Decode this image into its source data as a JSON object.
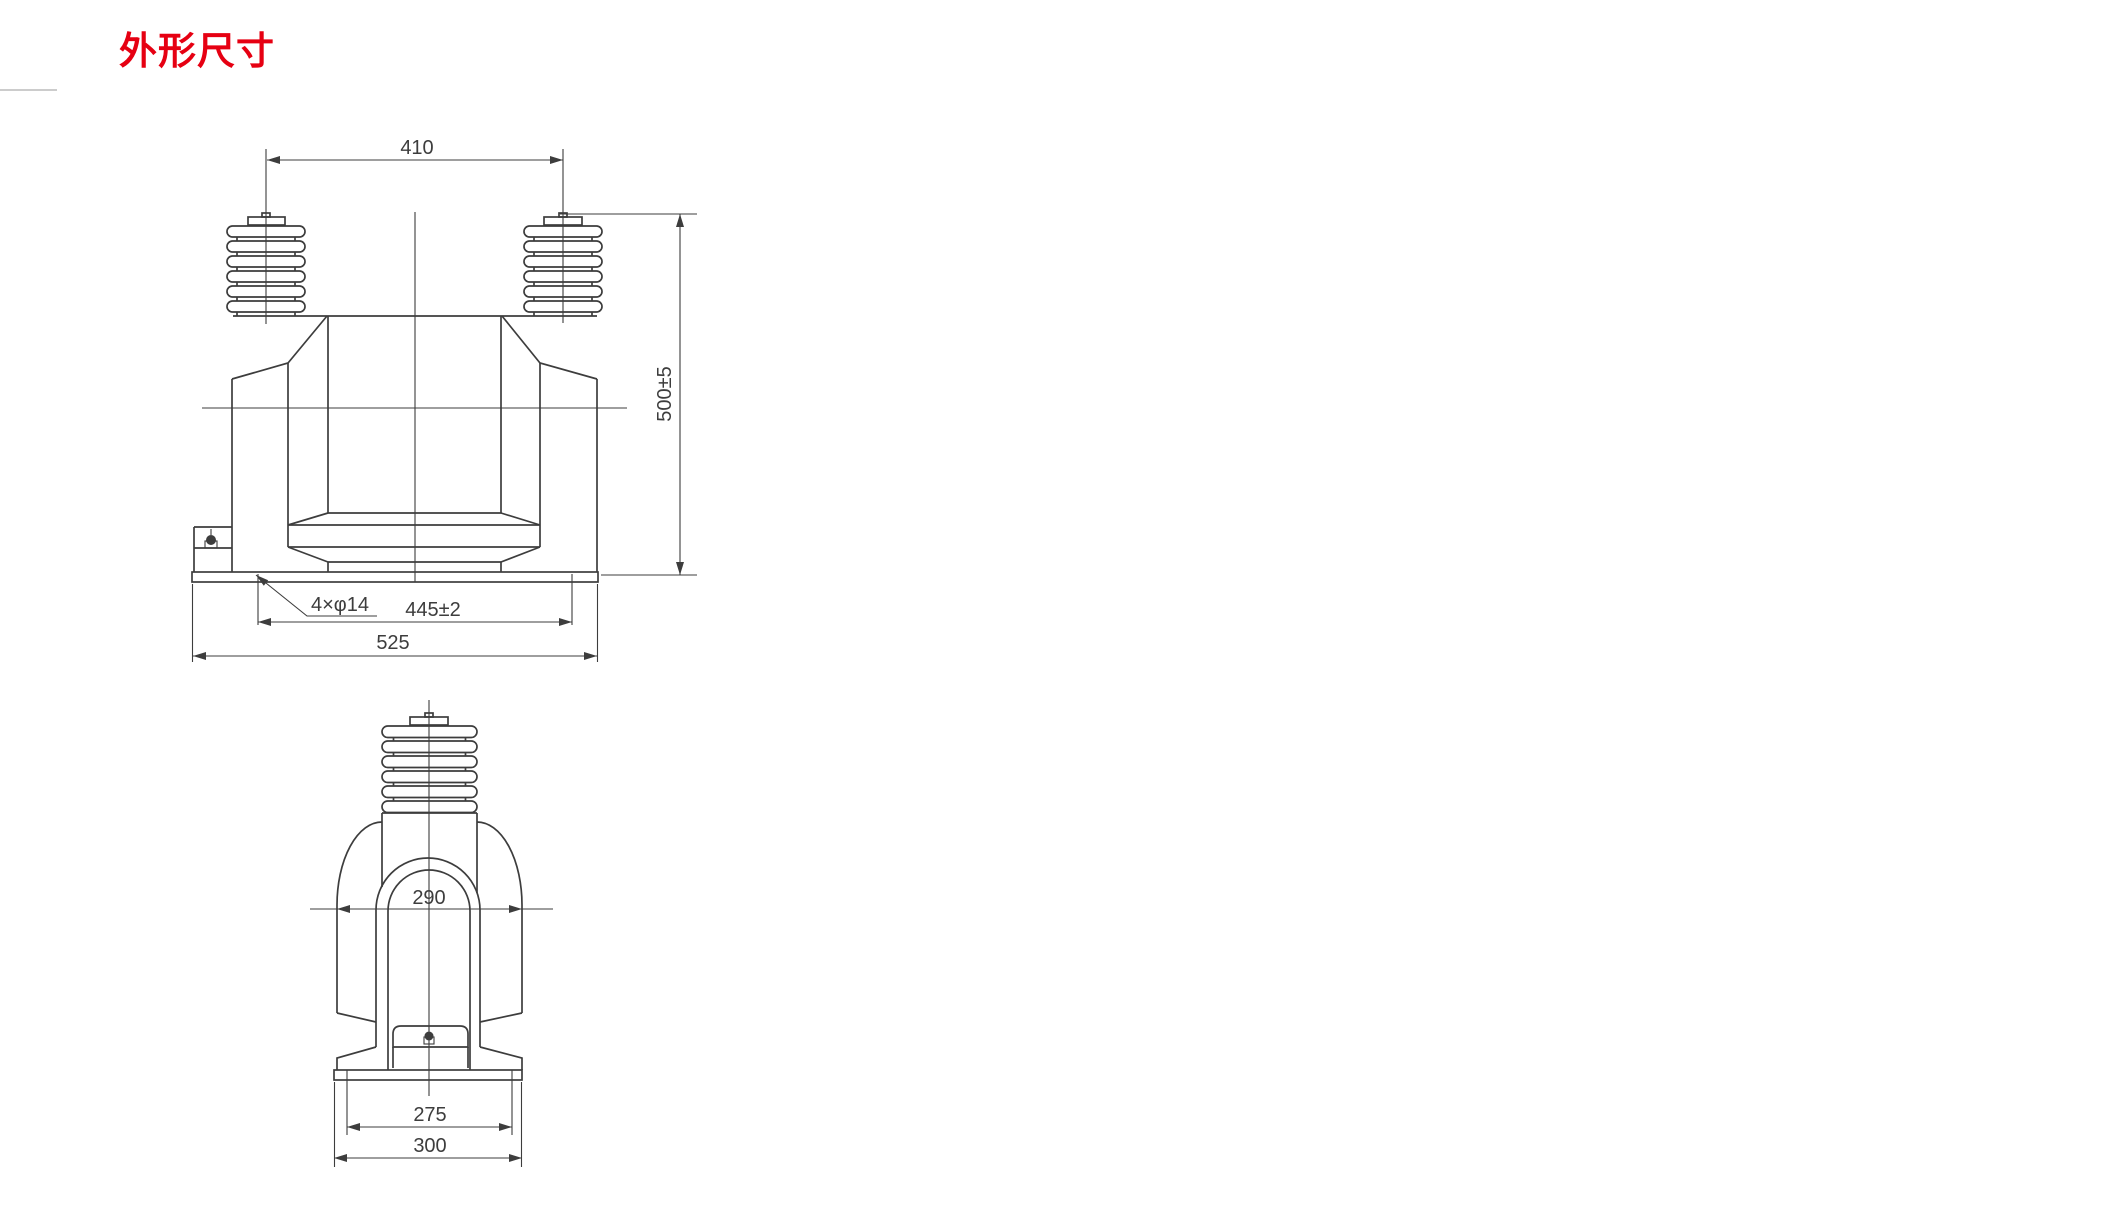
{
  "page": {
    "title": "外形尺寸",
    "title_color": "#e60012",
    "drawing_line_color": "#3d3d3d",
    "background_color": "#ffffff"
  },
  "front_view": {
    "description": "transformer-front-elevation",
    "dim_top_width": "410",
    "dim_height": "500±5",
    "label_mounting_holes": "4×φ14",
    "dim_hole_spacing": "445±2",
    "dim_base_width": "525"
  },
  "side_view": {
    "description": "transformer-side-elevation",
    "dim_dome_width": "290",
    "dim_hole_spacing": "275",
    "dim_base_width": "300"
  }
}
